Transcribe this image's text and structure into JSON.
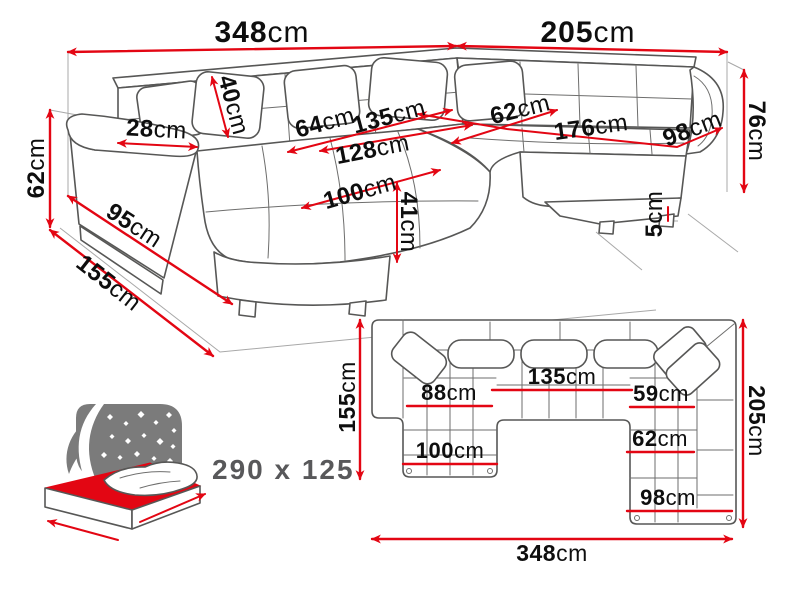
{
  "unit": "cm",
  "colors": {
    "dimension_red": "#e30613",
    "outline_gray": "#575756",
    "label_black": "#0e0e0e",
    "sky_gray": "#7b7b7b",
    "caption_gray": "#58585a",
    "background": "#ffffff"
  },
  "perspective_view": {
    "total_width_back": "348",
    "total_width_right": "205",
    "armrest_height": "62",
    "side_depth": "155",
    "base_length": "95",
    "armrest_width": "28",
    "back_cushion_height": "40",
    "corner_seat_depth": "64",
    "middle_seat_width": "135",
    "left_seat_length": "128",
    "right_seat_depth": "62",
    "right_seat_length": "176",
    "corner_width": "98",
    "chaise_length": "100",
    "seat_height": "41",
    "foot_height": "5",
    "backrest_height": "76"
  },
  "plan_view": {
    "left_side_depth": "155",
    "right_side_depth": "205",
    "total_width": "348",
    "chaise_seat_width": "88",
    "middle_seat_width": "135",
    "right_seat_width": "59",
    "chaise_full_width": "100",
    "right_seat_depth": "62",
    "right_section_width": "98"
  },
  "sleeping_area": {
    "caption": "290 x 125"
  }
}
